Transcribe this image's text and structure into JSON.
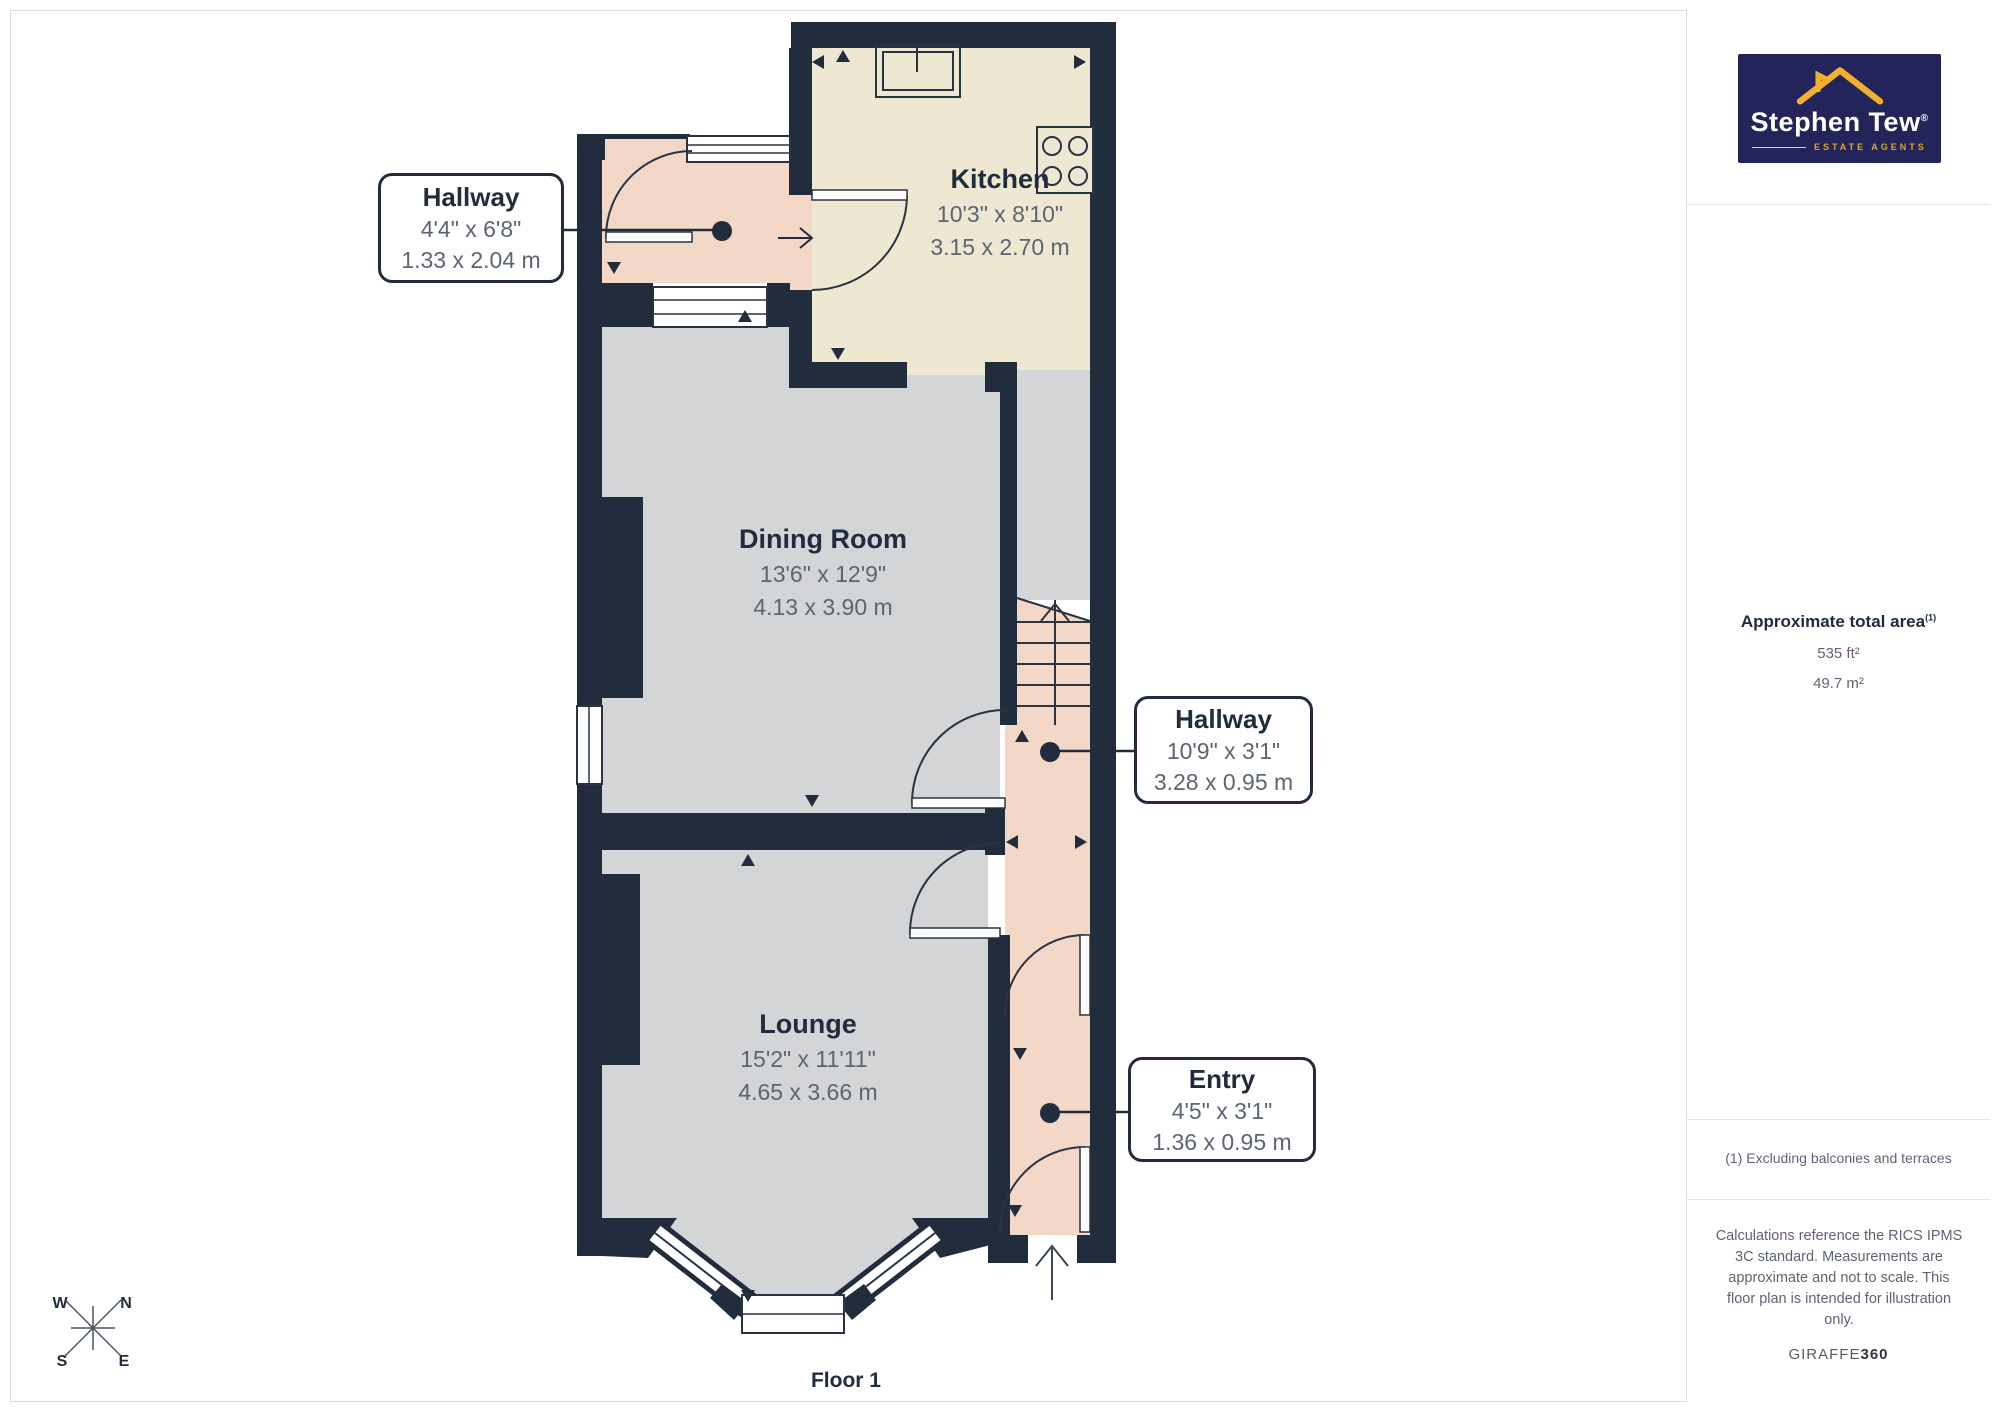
{
  "page": {
    "floor_label": "Floor 1"
  },
  "rooms": {
    "hallway1": {
      "name": "Hallway",
      "imperial": "4'4\" x 6'8\"",
      "metric": "1.33 x 2.04 m"
    },
    "kitchen": {
      "name": "Kitchen",
      "imperial": "10'3\" x 8'10\"",
      "metric": "3.15 x 2.70 m"
    },
    "dining_room": {
      "name": "Dining Room",
      "imperial": "13'6\" x 12'9\"",
      "metric": "4.13 x 3.90 m"
    },
    "hallway2": {
      "name": "Hallway",
      "imperial": "10'9\" x 3'1\"",
      "metric": "3.28 x 0.95 m"
    },
    "lounge": {
      "name": "Lounge",
      "imperial": "15'2\" x 11'11\"",
      "metric": "4.65 x 3.66 m"
    },
    "entry": {
      "name": "Entry",
      "imperial": "4'5\" x 3'1\"",
      "metric": "1.36 x 0.95 m"
    }
  },
  "sidebar": {
    "logo": {
      "brand": "Stephen Tew",
      "registered": "®",
      "tagline": "ESTATE AGENTS"
    },
    "area": {
      "title": "Approximate total area",
      "sup": "(1)",
      "imperial": "535 ft²",
      "metric": "49.7 m²"
    },
    "footnote": "(1) Excluding balconies and terraces",
    "disclaimer": "Calculations reference the RICS IPMS 3C standard. Measurements are approximate and not to scale. This floor plan is intended for illustration only.",
    "vendor": {
      "name": "GIRAFFE",
      "suffix": "360"
    }
  },
  "compass": {
    "n": "N",
    "e": "E",
    "s": "S",
    "w": "W"
  },
  "colors": {
    "wall": "#212c3c",
    "floor_gray": "#d4d5d7",
    "floor_cream": "#eee8d3",
    "floor_pink": "#f3d8c7",
    "label_text": "#212c3c",
    "dim_text": "#5d6572",
    "logo_bg": "#22245a",
    "logo_gold": "#f2b02c"
  }
}
